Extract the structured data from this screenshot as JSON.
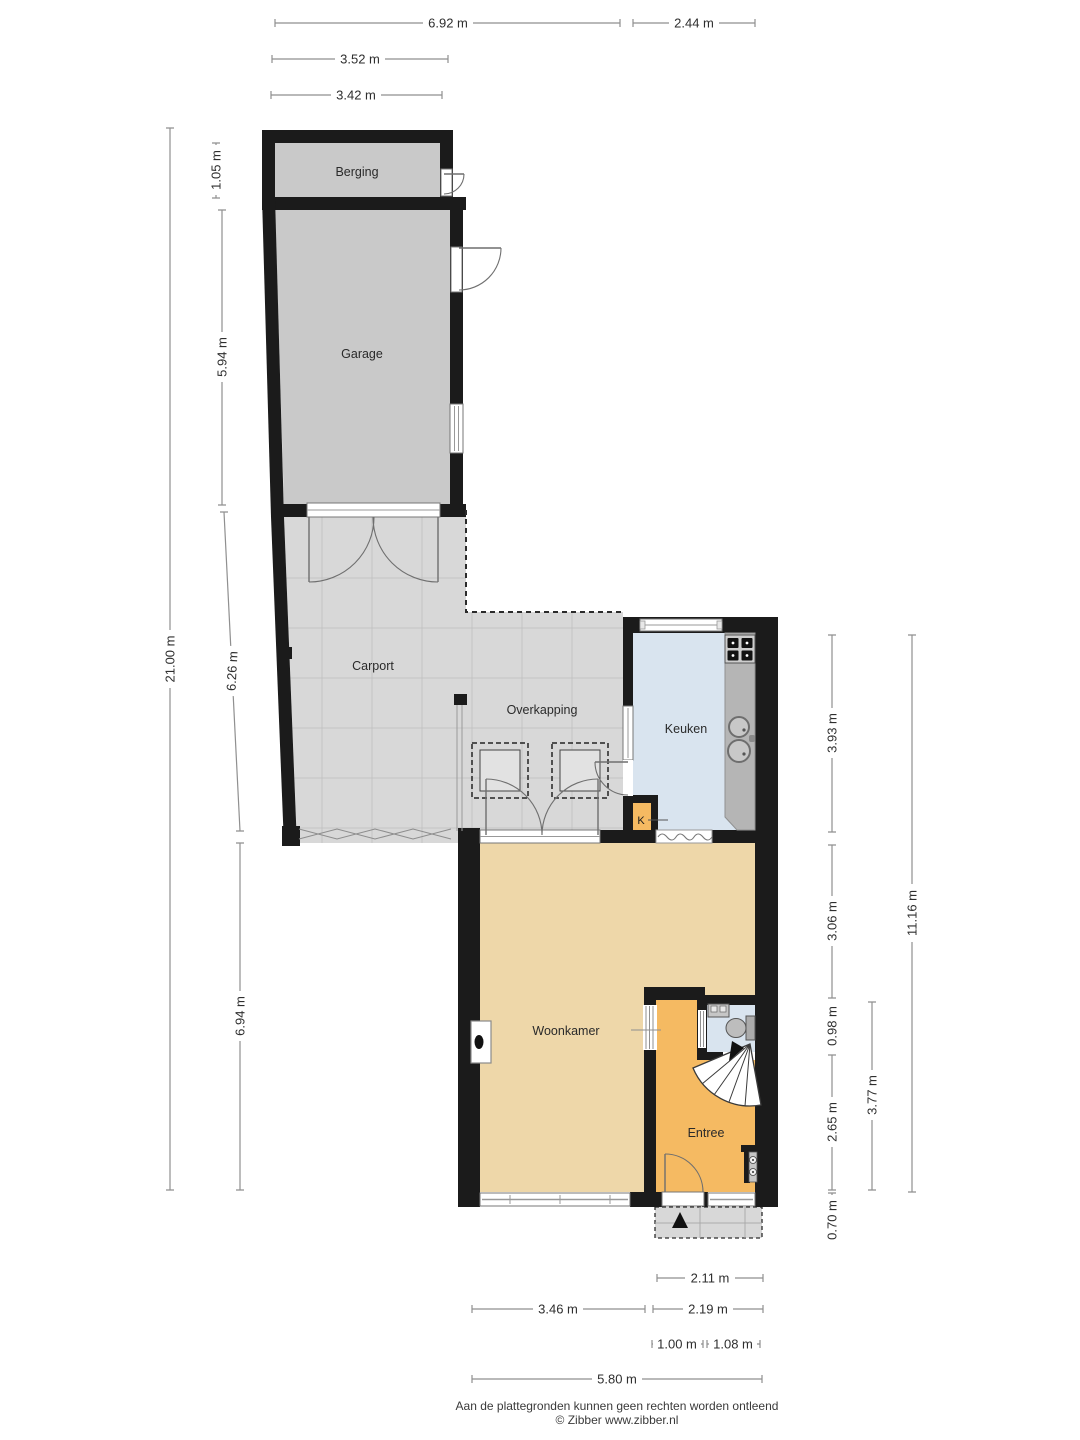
{
  "document": {
    "type": "floorplan",
    "language": "nl",
    "footer_line1": "Aan de plattegronden kunnen geen rechten worden ontleend",
    "footer_line2": "© Zibber www.zibber.nl"
  },
  "rooms": {
    "berging": {
      "label": "Berging"
    },
    "garage": {
      "label": "Garage"
    },
    "carport": {
      "label": "Carport"
    },
    "overkapping": {
      "label": "Overkapping"
    },
    "keuken": {
      "label": "Keuken"
    },
    "kast": {
      "label": "K"
    },
    "woonkamer": {
      "label": "Woonkamer"
    },
    "entree": {
      "label": "Entree"
    }
  },
  "dimensions": {
    "top": [
      {
        "label": "6.92 m",
        "value_m": 6.92
      },
      {
        "label": "2.44 m",
        "value_m": 2.44
      },
      {
        "label": "3.52 m",
        "value_m": 3.52
      },
      {
        "label": "3.42 m",
        "value_m": 3.42
      }
    ],
    "left": [
      {
        "label": "21.00 m",
        "value_m": 21.0
      },
      {
        "label": "1.05 m",
        "value_m": 1.05
      },
      {
        "label": "5.94 m",
        "value_m": 5.94
      },
      {
        "label": "6.26 m",
        "value_m": 6.26
      },
      {
        "label": "6.94 m",
        "value_m": 6.94
      }
    ],
    "right": [
      {
        "label": "3.93 m",
        "value_m": 3.93
      },
      {
        "label": "3.06 m",
        "value_m": 3.06
      },
      {
        "label": "0.98 m",
        "value_m": 0.98
      },
      {
        "label": "2.65 m",
        "value_m": 2.65
      },
      {
        "label": "0.70 m",
        "value_m": 0.7
      },
      {
        "label": "3.77 m",
        "value_m": 3.77
      },
      {
        "label": "11.16 m",
        "value_m": 11.16
      }
    ],
    "bottom": [
      {
        "label": "2.11 m",
        "value_m": 2.11
      },
      {
        "label": "3.46 m",
        "value_m": 3.46
      },
      {
        "label": "2.19 m",
        "value_m": 2.19
      },
      {
        "label": "1.00 m",
        "value_m": 1.0
      },
      {
        "label": "1.08 m",
        "value_m": 1.08
      },
      {
        "label": "5.80 m",
        "value_m": 5.8
      }
    ]
  },
  "colors": {
    "wall": "#1b1b1b",
    "storage_floor": "#c9c9c9",
    "outdoor_floor": "#d8d8d8",
    "kitchen_floor": "#d9e4ef",
    "living_floor": "#eed7a9",
    "hall_floor": "#f5ba62",
    "counter": "#b5b5b5",
    "dimension_line": "#8f8f8f"
  }
}
